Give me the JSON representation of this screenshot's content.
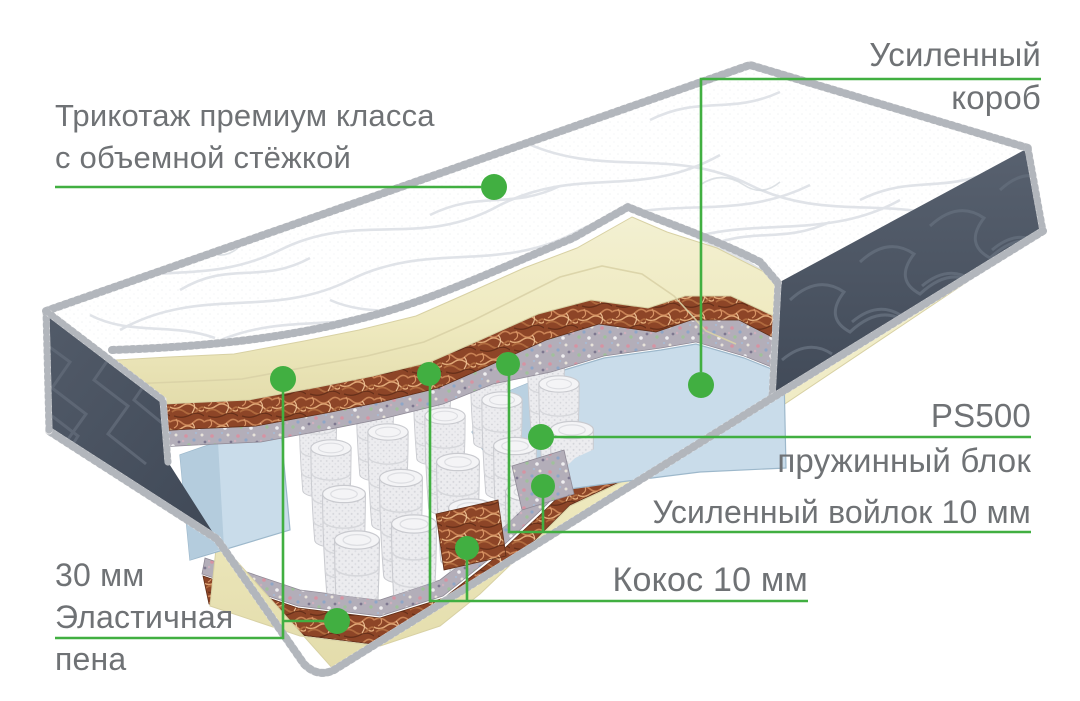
{
  "colors": {
    "accent_green": "#41af41",
    "label_gray": "#6f7275",
    "foam_cream": "#f0edca",
    "coco_brown": "#9a512f",
    "box_blue": "#c9dcea",
    "panel_dark": "#4d5664"
  },
  "callouts": {
    "fabric": "Трикотаж премиум класса\nс объемной стёжкой",
    "box": "Усиленный\nкороб",
    "spring_model": "PS500",
    "spring_block": "пружинный блок",
    "felt": "Усиленный войлок 10 мм",
    "coco": "Кокос 10 мм",
    "foam": "30 мм\nЭластичная\nпена"
  }
}
